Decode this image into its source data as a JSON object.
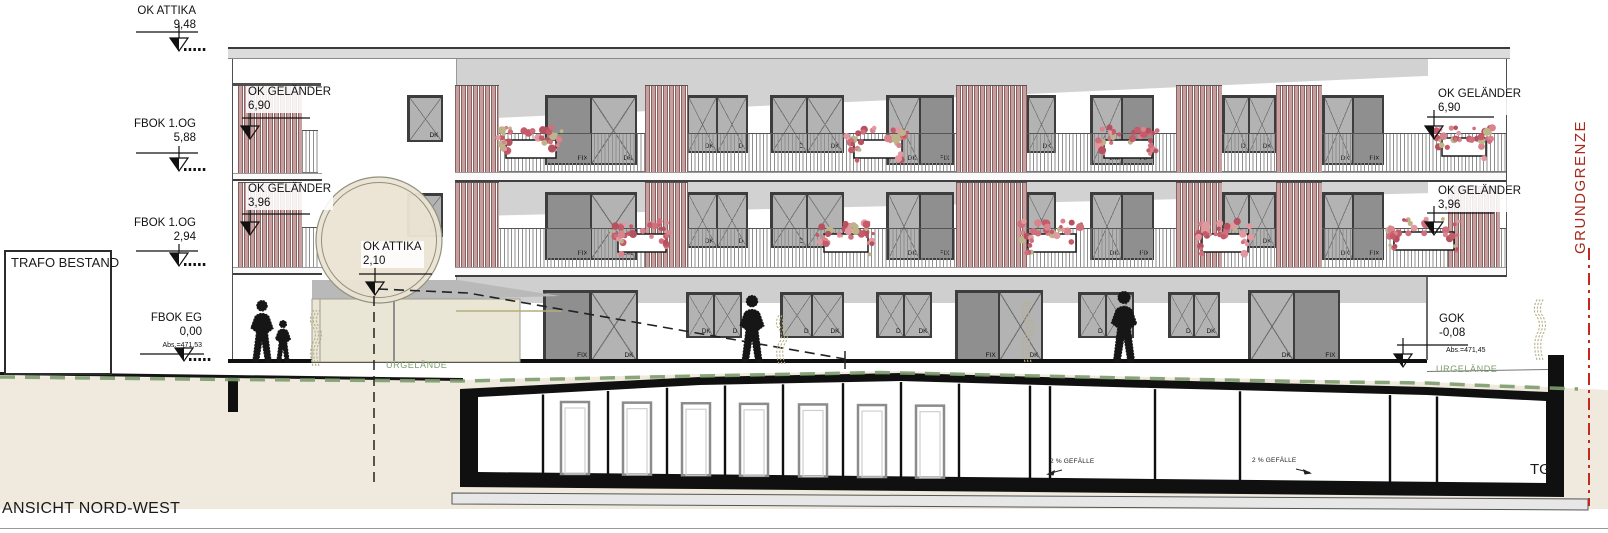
{
  "title": "ANSICHT NORD-WEST",
  "labels": {
    "trafo": "TRAFO BESTAND",
    "tg": "TG",
    "grundgrenze": "GRUNDGRENZE",
    "urgelaende": "URGELÄNDE",
    "gefaelle": "2 % GEFÄLLE"
  },
  "colors": {
    "facade_gray": "#d2d2d2",
    "slat_wood": "#c79f9f",
    "flower_pink": "#d9848d",
    "terrain_green": "#7d9c6e",
    "terrain_beige": "#efeadd",
    "boundary_red": "#c22a1e",
    "garage_black": "#101010"
  },
  "markers": [
    {
      "label": "OK ATTIKA",
      "value": "9,48",
      "align": "right",
      "tx": 196,
      "ty": 5,
      "line": [
        136,
        32,
        198
      ],
      "tip": [
        179,
        51
      ],
      "hatch": true
    },
    {
      "label": "FBOK 1.OG",
      "value": "5,88",
      "align": "right",
      "tx": 196,
      "ty": 118,
      "line": [
        136,
        153,
        198
      ],
      "tip": [
        179,
        171
      ],
      "hatch": true
    },
    {
      "label": "FBOK 1.OG",
      "value": "2,94",
      "align": "right",
      "tx": 196,
      "ty": 217,
      "line": [
        136,
        251,
        198
      ],
      "tip": [
        179,
        266
      ],
      "hatch": true
    },
    {
      "label": "FBOK EG",
      "value": "0,00",
      "sub": "Abs.=471,53",
      "align": "right",
      "tx": 202,
      "ty": 312,
      "line": [
        140,
        354,
        204
      ],
      "tip": [
        184,
        361
      ],
      "hatch": true
    },
    {
      "label": "OK GELÄNDER",
      "value": "6,90",
      "align": "left",
      "tx": 246,
      "ty": 86,
      "line": [
        242,
        118,
        310
      ],
      "tip": [
        250,
        139
      ]
    },
    {
      "label": "OK GELÄNDER",
      "value": "3,96",
      "align": "left",
      "tx": 246,
      "ty": 183,
      "line": [
        242,
        214,
        310
      ],
      "tip": [
        250,
        235
      ]
    },
    {
      "label": "OK ATTIKA",
      "value": "2,10",
      "align": "left",
      "tx": 361,
      "ty": 241,
      "line": [
        359,
        274,
        432
      ],
      "tip": [
        375,
        295
      ]
    },
    {
      "label": "OK GELÄNDER",
      "value": "6,90",
      "align": "left",
      "tx": 1436,
      "ty": 88,
      "line": [
        1427,
        117,
        1494
      ],
      "tip": [
        1434,
        139
      ]
    },
    {
      "label": "OK GELÄNDER",
      "value": "3,96",
      "align": "left",
      "tx": 1436,
      "ty": 185,
      "line": [
        1427,
        213,
        1494
      ],
      "tip": [
        1434,
        235
      ]
    },
    {
      "label": "GOK",
      "value": "-0,08",
      "sub": "Abs.=471,45",
      "align": "left",
      "tx": 1437,
      "ty": 313,
      "line": [
        1397,
        345,
        1468
      ],
      "tip": [
        1403,
        367
      ],
      "subx": 1446,
      "suby": 347
    }
  ],
  "building": {
    "windows": [
      {
        "x": 545,
        "y": 95,
        "w": 92,
        "h": 70,
        "panels": [
          {
            "t": "fix",
            "label": "FIX"
          },
          {
            "t": "g",
            "label": "DK"
          }
        ]
      },
      {
        "x": 686,
        "y": 95,
        "w": 62,
        "h": 58,
        "panels": [
          {
            "t": "g",
            "label": "DK"
          },
          {
            "t": "g",
            "label": "D"
          }
        ]
      },
      {
        "x": 770,
        "y": 95,
        "w": 74,
        "h": 58,
        "panels": [
          {
            "t": "g",
            "label": "D"
          },
          {
            "t": "g",
            "label": "DK"
          }
        ]
      },
      {
        "x": 886,
        "y": 95,
        "w": 68,
        "h": 70,
        "panels": [
          {
            "t": "g",
            "label": "DK"
          },
          {
            "t": "fix",
            "label": "FIX"
          }
        ]
      },
      {
        "x": 1000,
        "y": 95,
        "w": 56,
        "h": 58,
        "panels": [
          {
            "t": "g",
            "label": "D"
          },
          {
            "t": "g",
            "label": "DK"
          }
        ]
      },
      {
        "x": 1090,
        "y": 95,
        "w": 64,
        "h": 70,
        "panels": [
          {
            "t": "g",
            "label": "DK"
          },
          {
            "t": "fix",
            "label": "FIX"
          }
        ]
      },
      {
        "x": 1222,
        "y": 95,
        "w": 54,
        "h": 58,
        "panels": [
          {
            "t": "g",
            "label": "D"
          },
          {
            "t": "g",
            "label": "DK"
          }
        ]
      },
      {
        "x": 1322,
        "y": 95,
        "w": 62,
        "h": 70,
        "panels": [
          {
            "t": "g",
            "label": "DK"
          },
          {
            "t": "fix",
            "label": "FIX"
          }
        ]
      },
      {
        "x": 545,
        "y": 192,
        "w": 92,
        "h": 68,
        "panels": [
          {
            "t": "fix",
            "label": "FIX"
          },
          {
            "t": "g",
            "label": "DK"
          }
        ]
      },
      {
        "x": 686,
        "y": 192,
        "w": 62,
        "h": 56,
        "panels": [
          {
            "t": "g",
            "label": "DK"
          },
          {
            "t": "g",
            "label": "D"
          }
        ]
      },
      {
        "x": 770,
        "y": 192,
        "w": 74,
        "h": 56,
        "panels": [
          {
            "t": "g",
            "label": "D"
          },
          {
            "t": "g",
            "label": "DK"
          }
        ]
      },
      {
        "x": 886,
        "y": 192,
        "w": 68,
        "h": 68,
        "panels": [
          {
            "t": "g",
            "label": "DK"
          },
          {
            "t": "fix",
            "label": "FIX"
          }
        ]
      },
      {
        "x": 1000,
        "y": 192,
        "w": 56,
        "h": 56,
        "panels": [
          {
            "t": "g",
            "label": "D"
          },
          {
            "t": "g",
            "label": "DK"
          }
        ]
      },
      {
        "x": 1090,
        "y": 192,
        "w": 64,
        "h": 68,
        "panels": [
          {
            "t": "g",
            "label": "DK"
          },
          {
            "t": "fix",
            "label": "FIX"
          }
        ]
      },
      {
        "x": 1222,
        "y": 192,
        "w": 54,
        "h": 56,
        "panels": [
          {
            "t": "g",
            "label": "D"
          },
          {
            "t": "g",
            "label": "DK"
          }
        ]
      },
      {
        "x": 1322,
        "y": 192,
        "w": 62,
        "h": 68,
        "panels": [
          {
            "t": "g",
            "label": "DK"
          },
          {
            "t": "fix",
            "label": "FIX"
          }
        ]
      },
      {
        "x": 407,
        "y": 95,
        "w": 36,
        "h": 47,
        "panels": [
          {
            "t": "g",
            "label": "DK"
          }
        ]
      },
      {
        "x": 407,
        "y": 193,
        "w": 36,
        "h": 44,
        "panels": [
          {
            "t": "g",
            "label": "DK"
          }
        ]
      },
      {
        "x": 543,
        "y": 290,
        "w": 95,
        "h": 72,
        "panels": [
          {
            "t": "fix",
            "label": "FIX"
          },
          {
            "t": "g",
            "label": "DK"
          }
        ]
      },
      {
        "x": 686,
        "y": 292,
        "w": 56,
        "h": 46,
        "panels": [
          {
            "t": "g",
            "label": "DK"
          },
          {
            "t": "g",
            "label": "D"
          }
        ]
      },
      {
        "x": 780,
        "y": 292,
        "w": 64,
        "h": 46,
        "panels": [
          {
            "t": "g",
            "label": "D"
          },
          {
            "t": "g",
            "label": "DK"
          }
        ]
      },
      {
        "x": 876,
        "y": 292,
        "w": 56,
        "h": 46,
        "panels": [
          {
            "t": "g",
            "label": "D"
          },
          {
            "t": "g",
            "label": "DK"
          }
        ]
      },
      {
        "x": 955,
        "y": 290,
        "w": 88,
        "h": 72,
        "panels": [
          {
            "t": "fix",
            "label": "FIX"
          },
          {
            "t": "g",
            "label": "DK"
          }
        ]
      },
      {
        "x": 1078,
        "y": 292,
        "w": 56,
        "h": 46,
        "panels": [
          {
            "t": "g",
            "label": "D"
          },
          {
            "t": "g",
            "label": "DK"
          }
        ]
      },
      {
        "x": 1168,
        "y": 292,
        "w": 52,
        "h": 46,
        "panels": [
          {
            "t": "g",
            "label": "D"
          },
          {
            "t": "g",
            "label": "DK"
          }
        ]
      },
      {
        "x": 1248,
        "y": 290,
        "w": 92,
        "h": 72,
        "panels": [
          {
            "t": "g",
            "label": "DK"
          },
          {
            "t": "fix",
            "label": "FIX"
          }
        ]
      }
    ],
    "slats": [
      {
        "x": 238,
        "y": 85,
        "w": 64,
        "h": 89
      },
      {
        "x": 455,
        "y": 85,
        "w": 44,
        "h": 88
      },
      {
        "x": 645,
        "y": 85,
        "w": 43,
        "h": 88
      },
      {
        "x": 956,
        "y": 85,
        "w": 71,
        "h": 88
      },
      {
        "x": 1176,
        "y": 85,
        "w": 46,
        "h": 88
      },
      {
        "x": 1276,
        "y": 85,
        "w": 46,
        "h": 88
      },
      {
        "x": 238,
        "y": 182,
        "w": 64,
        "h": 88
      },
      {
        "x": 455,
        "y": 182,
        "w": 44,
        "h": 86
      },
      {
        "x": 645,
        "y": 182,
        "w": 43,
        "h": 86
      },
      {
        "x": 956,
        "y": 182,
        "w": 71,
        "h": 86
      },
      {
        "x": 1176,
        "y": 182,
        "w": 46,
        "h": 86
      },
      {
        "x": 1276,
        "y": 182,
        "w": 46,
        "h": 86
      },
      {
        "x": 1448,
        "y": 186,
        "w": 52,
        "h": 82
      }
    ],
    "railings": [
      {
        "x": 457,
        "y": 133,
        "w": 1050,
        "h": 39
      },
      {
        "x": 457,
        "y": 228,
        "w": 1050,
        "h": 40
      },
      {
        "x": 302,
        "y": 130,
        "w": 16,
        "h": 43
      },
      {
        "x": 302,
        "y": 227,
        "w": 16,
        "h": 42
      }
    ],
    "flowers": [
      {
        "x": 500,
        "y": 128,
        "w": 62
      },
      {
        "x": 848,
        "y": 128,
        "w": 60
      },
      {
        "x": 1098,
        "y": 128,
        "w": 60
      },
      {
        "x": 1436,
        "y": 126,
        "w": 56
      },
      {
        "x": 612,
        "y": 222,
        "w": 60
      },
      {
        "x": 818,
        "y": 222,
        "w": 56
      },
      {
        "x": 1022,
        "y": 222,
        "w": 60
      },
      {
        "x": 1196,
        "y": 222,
        "w": 58
      },
      {
        "x": 1388,
        "y": 220,
        "w": 72
      }
    ]
  },
  "people": [
    {
      "x": 262,
      "y": 300,
      "h": 62
    },
    {
      "x": 283,
      "y": 320,
      "h": 42
    },
    {
      "x": 752,
      "y": 295,
      "h": 67
    },
    {
      "x": 1124,
      "y": 291,
      "h": 71
    }
  ],
  "plants": [
    {
      "x": 316,
      "y": 310,
      "h": 56
    },
    {
      "x": 782,
      "y": 314,
      "h": 50
    },
    {
      "x": 1028,
      "y": 302,
      "h": 60
    },
    {
      "x": 1540,
      "y": 298,
      "h": 62
    }
  ],
  "garage": {
    "partitions": [
      543,
      608,
      667,
      725,
      783,
      843,
      901,
      959,
      1030,
      1050,
      1155,
      1240,
      1390,
      1437
    ],
    "doors": [
      561,
      623,
      682,
      740,
      799,
      858,
      916
    ],
    "gefaelle": [
      {
        "x": 1050,
        "y": 458
      },
      {
        "x": 1252,
        "y": 457
      }
    ]
  }
}
